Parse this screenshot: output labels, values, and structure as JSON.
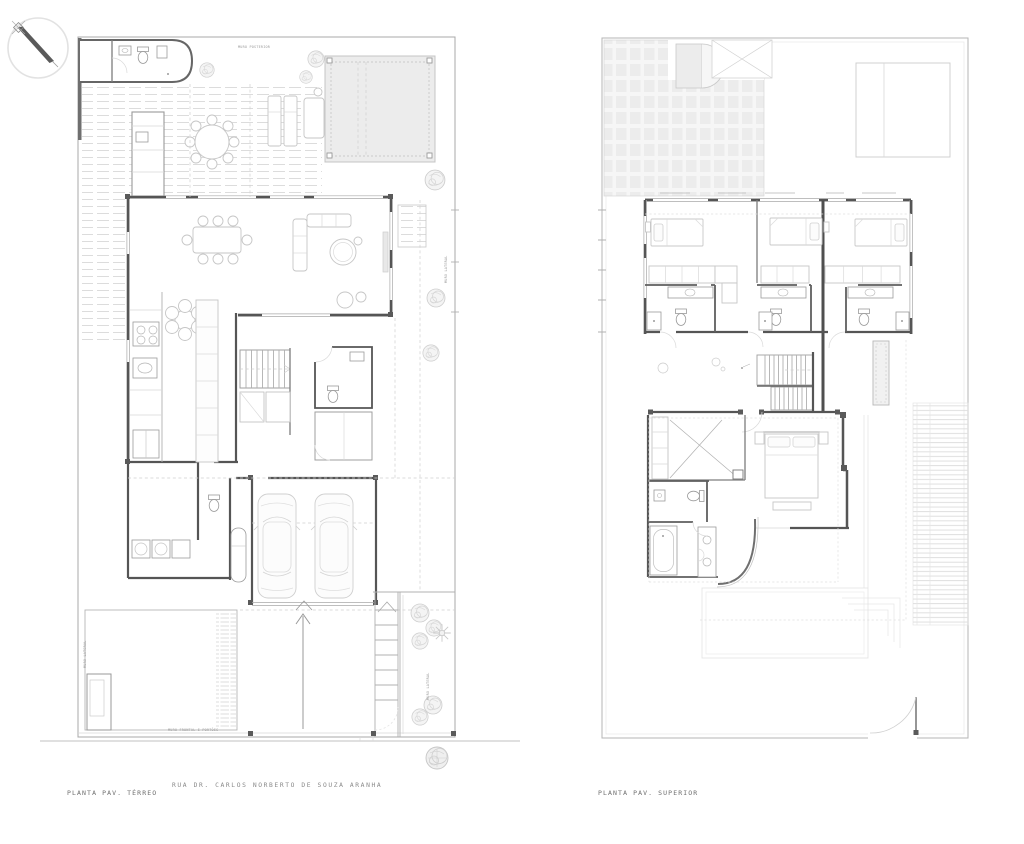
{
  "canvas": {
    "width": 1024,
    "height": 844,
    "background": "#ffffff"
  },
  "palette": {
    "wall": "#555555",
    "line": "#b0b0b0",
    "line_light": "#d9d9d9",
    "fill_light": "#ececec",
    "label_text": "#6e6e6e",
    "street_text": "#8a8a8a",
    "tiny_text": "#9a9a9a"
  },
  "ground_floor": {
    "title": "PLANTA PAV. TÉRREO",
    "street_name": "RUA DR. CARLOS NORBERTO DE SOUZA ARANHA",
    "wall_labels": {
      "rear": "MURO POSTERIOR",
      "side_left": "MURO LATERAL",
      "side_right": "MURO LATERAL",
      "front": "MURO FRONTAL E PORTÕES"
    }
  },
  "upper_floor": {
    "title": "PLANTA PAV. SUPERIOR"
  }
}
